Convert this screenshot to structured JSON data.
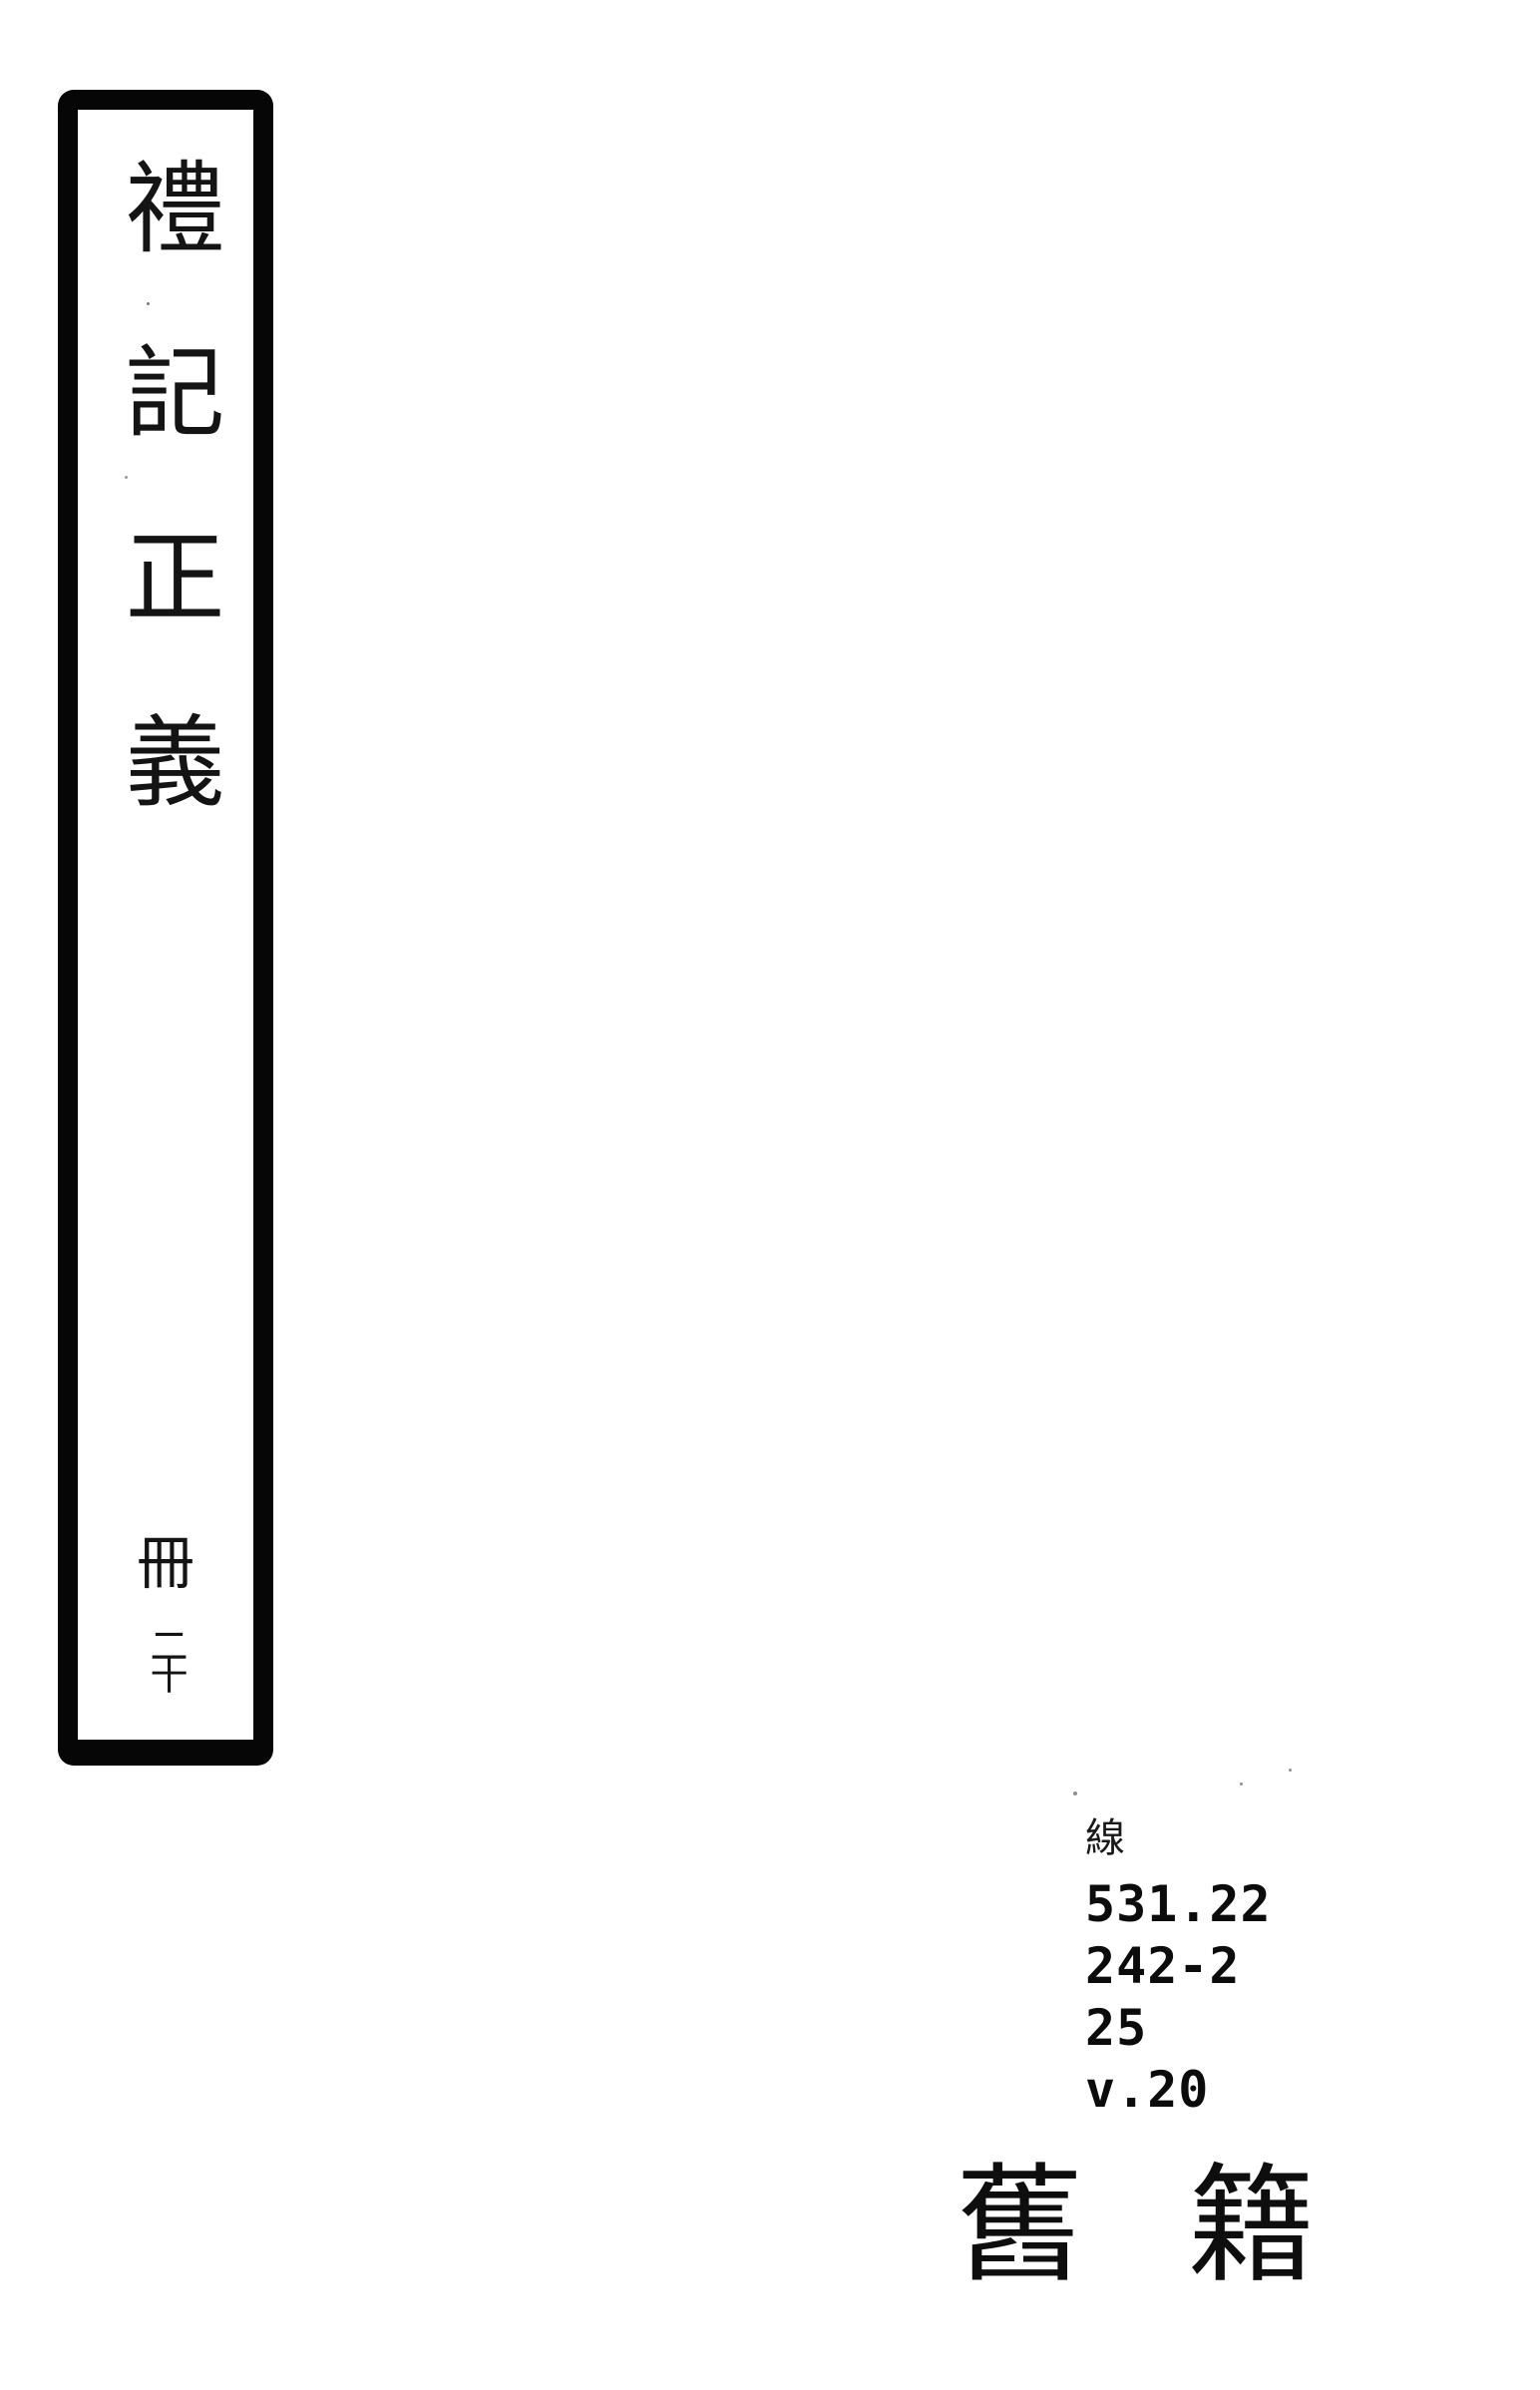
{
  "colors": {
    "background": "#ffffff",
    "ink": "#101010",
    "border": "#060606"
  },
  "spine_label": {
    "title": "禮記正義",
    "volume_marker": "冊",
    "volume_number": "二十"
  },
  "call_number": {
    "category_char": "線",
    "lines": [
      "531.22",
      "242-2",
      "25",
      "v.20"
    ]
  },
  "collection_stamp": {
    "first_char": "舊",
    "second_char": "籍"
  }
}
